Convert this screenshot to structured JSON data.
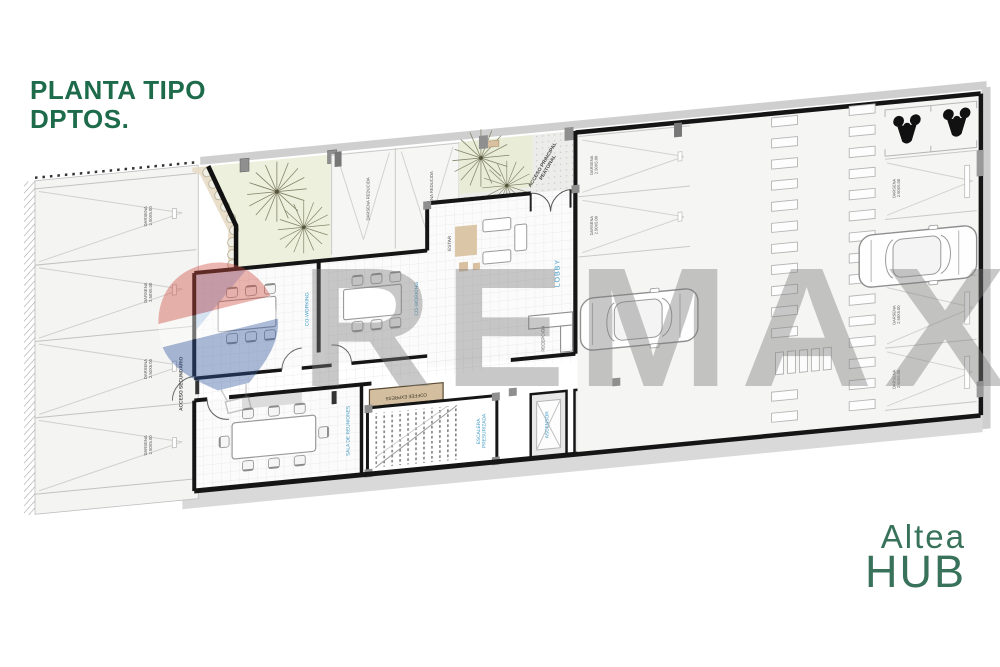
{
  "title": {
    "line1": "PLANTA TIPO",
    "line2": "DPTOS."
  },
  "watermark": {
    "text": "REMAX"
  },
  "logo": {
    "line1": "Altea",
    "line2": "HUB"
  },
  "plan": {
    "access": {
      "secondary": "ACCESO SECUNDARIO",
      "main_line1": "ACCESO PRINCIPAL",
      "main_line2": "PEATONAL"
    },
    "rooms": {
      "coworking": "CO-WORKING",
      "meeting": "SALA DE REUNIONES",
      "coffee": "COFFEE EXPRESS",
      "stair_line1": "ESCALERA",
      "stair_line2": "PRESURIZADA",
      "elevator": "ASCENSOR",
      "bathroom": "BAÑO",
      "laundry": "LAVADERO",
      "lobby": "LOBBY",
      "lounge": "ESTAR",
      "reception": "RECEPCIÓN"
    },
    "parking": {
      "stall": "DARSENA",
      "stall_size": "2.50X5.00",
      "stall_reduced": "DARSENA REDUCIDA"
    }
  },
  "colors": {
    "title_green": "#1d6b4a",
    "logo_green": "#38725a",
    "label_blue": "#3b97c2",
    "wall_black": "#151515",
    "garden_green": "#e9edd8",
    "beige": "#d9c0a0",
    "watermark_gray": "#7d7d7d",
    "balloon_red": "#cf4a3e",
    "balloon_blue": "#30569f"
  }
}
